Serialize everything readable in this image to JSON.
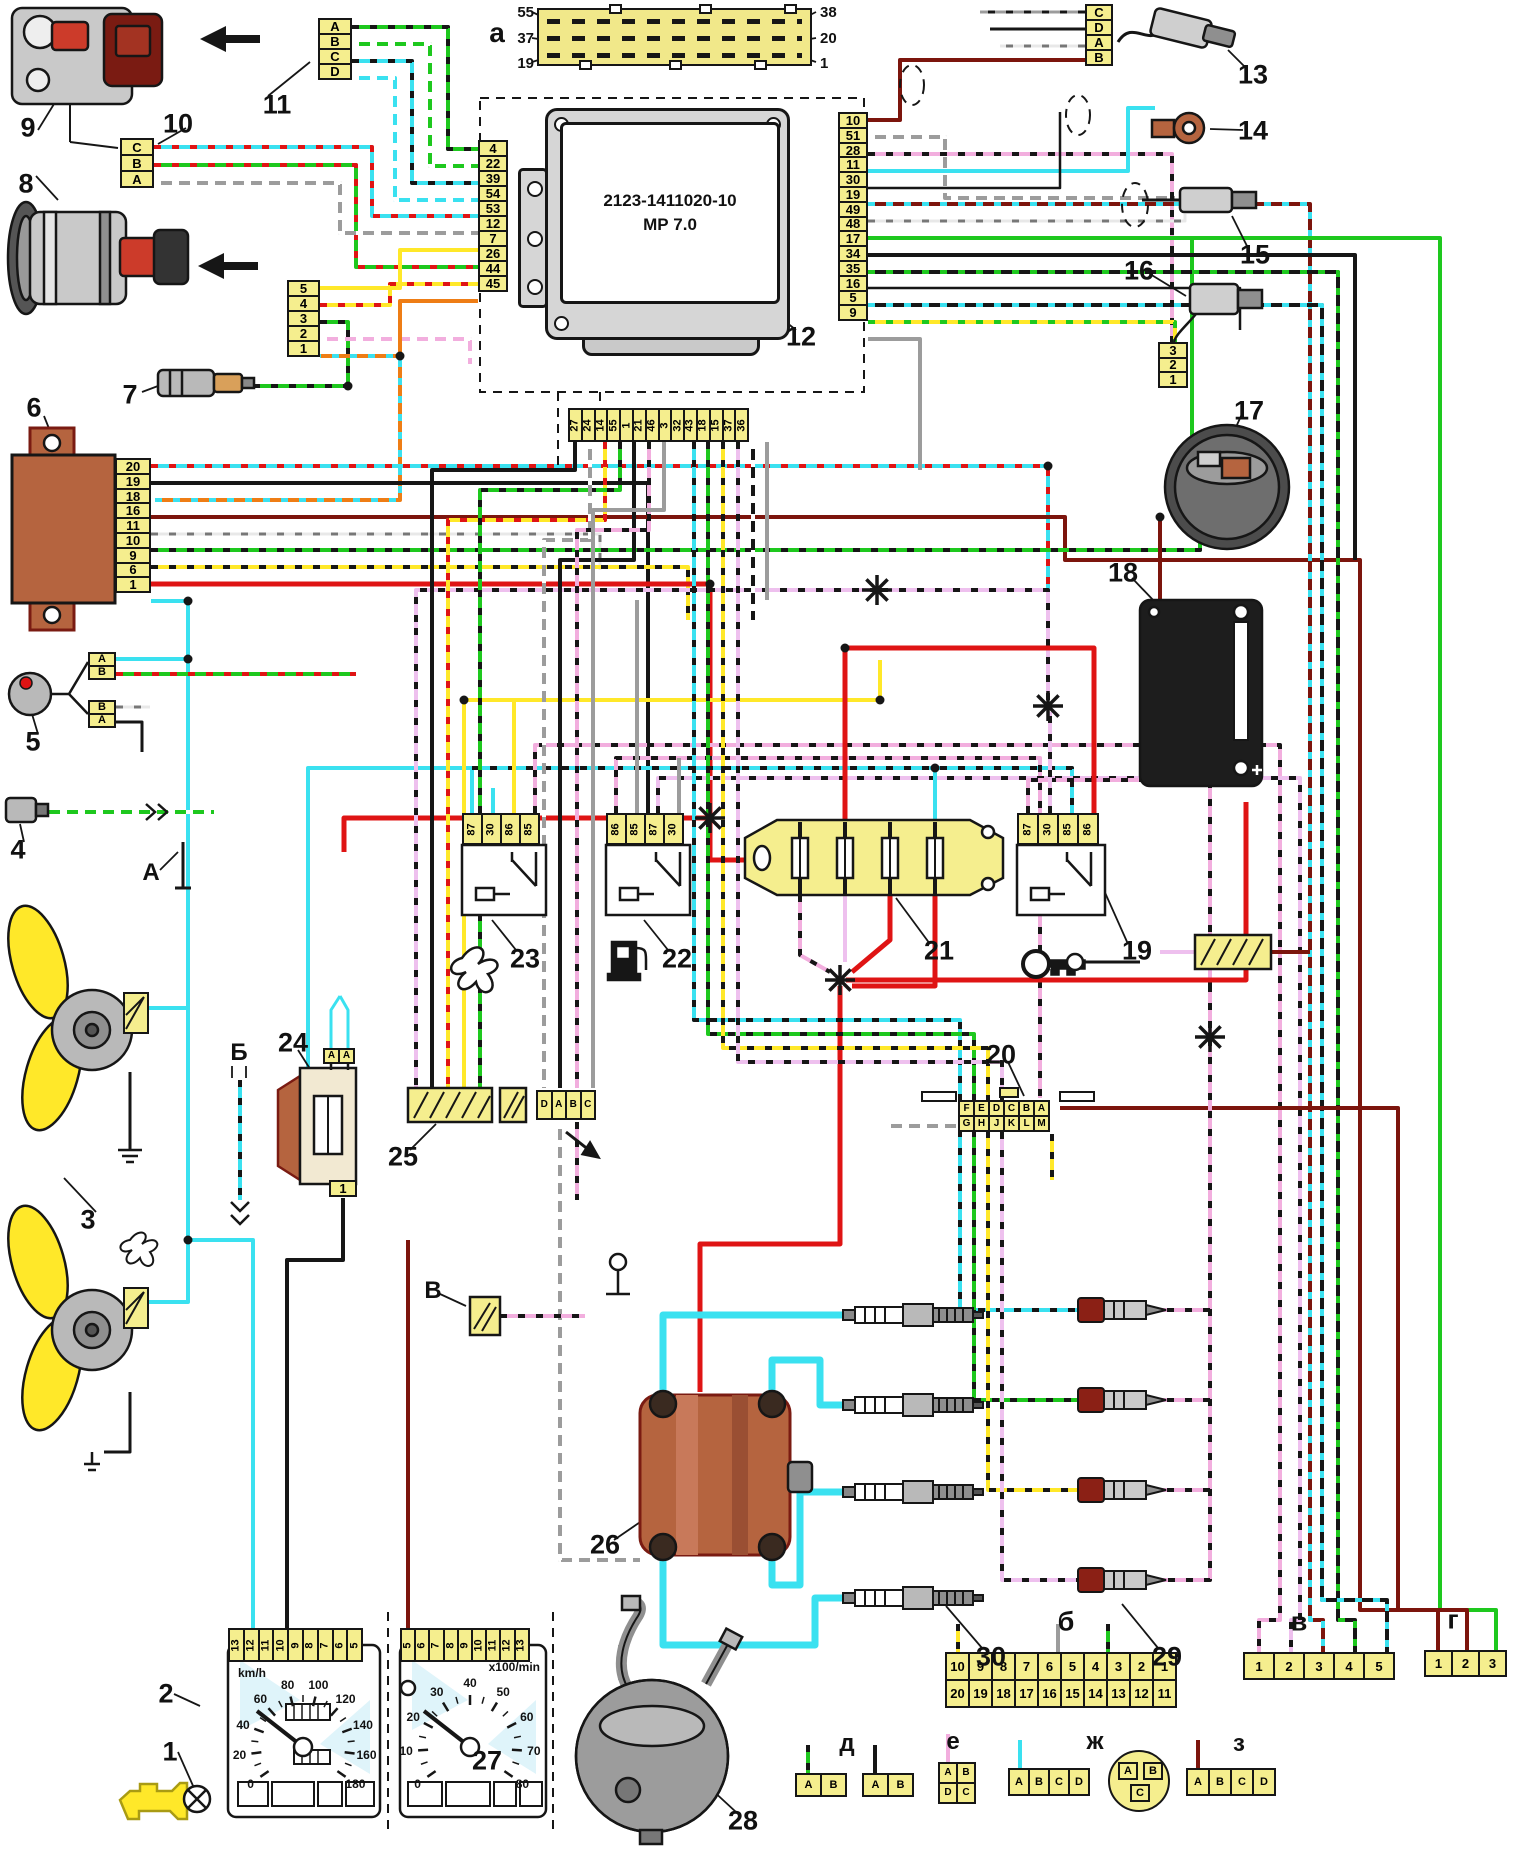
{
  "ecu": {
    "model": "2123-1411020-10",
    "version": "МР 7.0"
  },
  "connector_a": {
    "label": "а",
    "left_pins": [
      "55",
      "37",
      "19"
    ],
    "right_pins": [
      "38",
      "20",
      "1"
    ]
  },
  "pinblocks": {
    "conn11": [
      "A",
      "B",
      "C",
      "D"
    ],
    "conn10": [
      "C",
      "B",
      "A"
    ],
    "maf8": [
      "5",
      "4",
      "3",
      "2",
      "1"
    ],
    "immo6": [
      "20",
      "19",
      "18",
      "16",
      "11",
      "10",
      "9",
      "6",
      "1"
    ],
    "co5a": [
      "A",
      "B"
    ],
    "co5b": [
      "B",
      "A"
    ],
    "ecu_left": [
      "4",
      "22",
      "39",
      "54",
      "53",
      "12",
      "7",
      "26",
      "44",
      "45"
    ],
    "ecu_right": [
      "10",
      "51",
      "28",
      "11",
      "30",
      "19",
      "49",
      "48",
      "17",
      "34",
      "35",
      "16",
      "5",
      "9"
    ],
    "ecu_bottom": [
      "27",
      "24",
      "14",
      "55",
      "1",
      "21",
      "46",
      "3",
      "32",
      "43",
      "18",
      "15",
      "37",
      "36"
    ],
    "relay23": [
      "87",
      "30",
      "86",
      "85"
    ],
    "relay22": [
      "86",
      "85",
      "87",
      "30"
    ],
    "relay19": [
      "87",
      "30",
      "85",
      "86"
    ],
    "conn13": [
      "C",
      "D",
      "A",
      "B"
    ],
    "conn16": [
      "3",
      "2",
      "1"
    ],
    "conn20top": [
      "F",
      "E",
      "D",
      "C",
      "B",
      "A"
    ],
    "conn20bot": [
      "G",
      "H",
      "J",
      "K",
      "L",
      "M"
    ],
    "conn24top": [
      "A",
      "A"
    ],
    "conn24bot": [
      "1"
    ],
    "dabc": [
      "D",
      "A",
      "B",
      "C"
    ],
    "cl2pins": [
      "13",
      "12",
      "11",
      "10",
      "9",
      "8",
      "7",
      "6",
      "5"
    ],
    "cl27pins": [
      "5",
      "6",
      "7",
      "8",
      "9",
      "10",
      "11",
      "12",
      "13"
    ],
    "connBtop": [
      "10",
      "9",
      "8",
      "7",
      "6",
      "5",
      "4",
      "3",
      "2",
      "1"
    ],
    "connBbot": [
      "20",
      "19",
      "18",
      "17",
      "16",
      "15",
      "14",
      "13",
      "12",
      "11"
    ],
    "connV": [
      "1",
      "2",
      "3",
      "4",
      "5"
    ],
    "connG": [
      "1",
      "2",
      "3"
    ],
    "connD1": [
      "A",
      "B"
    ],
    "connD2": [
      "A",
      "B"
    ],
    "connEtop": [
      "A",
      "B"
    ],
    "connEbot": [
      "D",
      "C"
    ],
    "connZh1": [
      "A",
      "B",
      "C",
      "D"
    ],
    "connZh2": [
      "A",
      "B",
      "C"
    ],
    "connZ": [
      "A",
      "B",
      "C",
      "D"
    ]
  },
  "callouts": {
    "c1": "1",
    "c2": "2",
    "c3": "3",
    "c4": "4",
    "c5": "5",
    "c6": "6",
    "c7": "7",
    "c8": "8",
    "c9": "9",
    "c10": "10",
    "c11": "11",
    "c12": "12",
    "c13": "13",
    "c14": "14",
    "c15": "15",
    "c16": "16",
    "c17": "17",
    "c18": "18",
    "c19": "19",
    "c20": "20",
    "c21": "21",
    "c22": "22",
    "c23": "23",
    "c24": "24",
    "c25": "25",
    "c26": "26",
    "c27": "27",
    "c28": "28",
    "c29": "29",
    "c30": "30",
    "la": "а",
    "lb": "б",
    "lv": "в",
    "lg": "г",
    "ld": "д",
    "le": "е",
    "lzh": "ж",
    "lz": "з",
    "uA": "А",
    "uB": "Б",
    "uV": "В"
  },
  "gauges": {
    "speedo": {
      "unit": "km/h",
      "ticks": [
        "0",
        "20",
        "40",
        "60",
        "80",
        "100",
        "120",
        "140",
        "160",
        "180"
      ]
    },
    "tach": {
      "unit": "x100/min",
      "ticks": [
        "0",
        "10",
        "20",
        "30",
        "40",
        "50",
        "60",
        "70",
        "80"
      ]
    }
  },
  "icons": {
    "fan": "fan-icon",
    "fuel_pump": "fuel-pump-icon",
    "key": "key-icon",
    "check_engine": "check-engine-lamp-icon",
    "ground": "ground-icon",
    "splice": "splice-junction-icon"
  },
  "wire_colors": {
    "green": "#1ec81e",
    "cyan": "#3ae1f0",
    "yellow": "#ffe829",
    "pink": "#f2aede",
    "violet": "#eec0ee",
    "red": "#df1414",
    "dark_red": "#7c150d",
    "orange": "#ee7d15",
    "gray": "#9c9c9c",
    "black": "#161616",
    "connector_yellow": "#f5ee8e",
    "module_brown": "#b5643f"
  }
}
